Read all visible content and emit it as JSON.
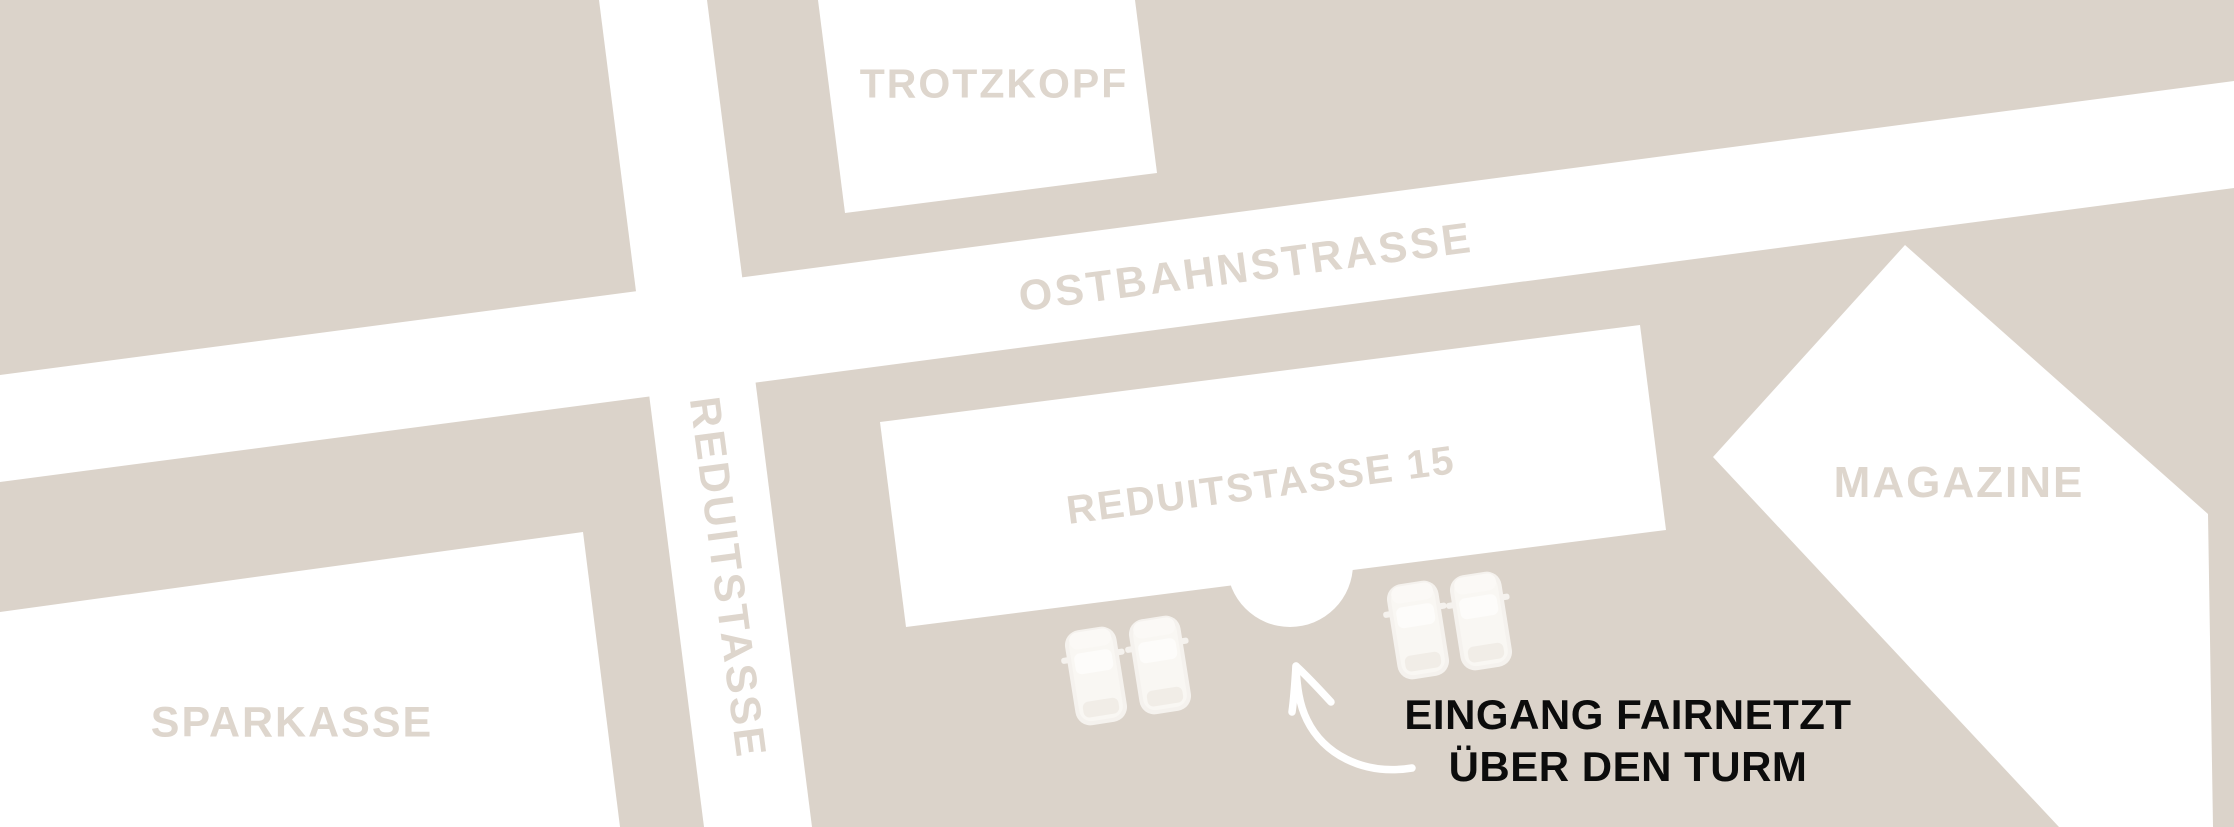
{
  "map": {
    "colors": {
      "background": "#dbd3ca",
      "street_and_building_fill": "#ffffff",
      "label_text": "#ded6cd",
      "annotation_text": "#0c0c0c",
      "car_body": "#f5f2ee",
      "car_body_inner": "#f9f7f3",
      "car_glass": "#fdfcfa",
      "car_rear": "#f1ede7",
      "arrow": "#ffffff"
    },
    "streets": [
      {
        "id": "ostbahnstrasse",
        "label": "OSTBAHNSTRASSE"
      },
      {
        "id": "reduitstasse",
        "label": "REDUITSTASSE"
      }
    ],
    "buildings": [
      {
        "id": "trotzkopf",
        "label": "TROTZKOPF"
      },
      {
        "id": "reduitstasse15",
        "label": "REDUITSTASSE 15"
      },
      {
        "id": "sparkasse",
        "label": "SPARKASSE"
      },
      {
        "id": "magazine",
        "label": "MAGAZINE"
      }
    ],
    "annotation": {
      "line1": "EINGANG FAIRNETZT",
      "line2": "ÜBER DEN TURM"
    },
    "features": {
      "tower_entrance": "round tower bump on south facade of REDUITSTASSE 15",
      "cars_parked": 4
    }
  }
}
